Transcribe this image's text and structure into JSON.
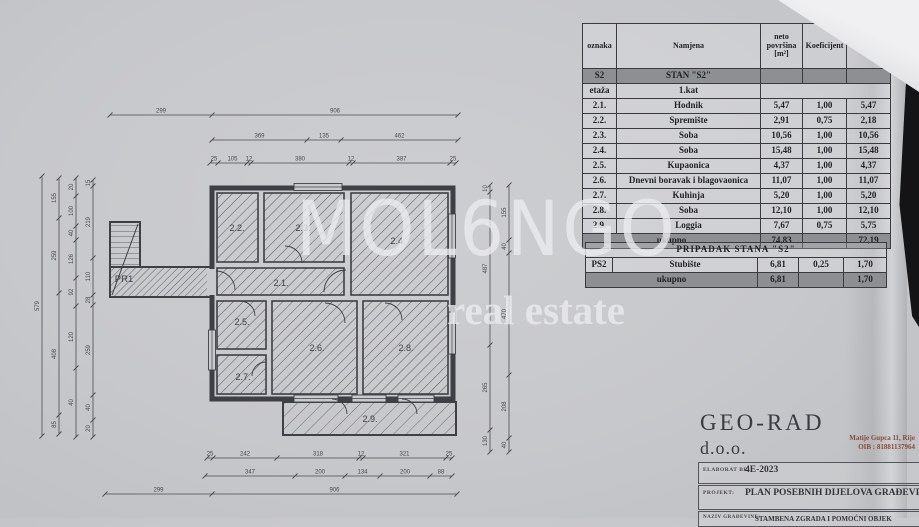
{
  "watermark": {
    "line1": "MOL6NGO",
    "line2": "real estate"
  },
  "main_table": {
    "headers": [
      "oznaka",
      "Namjena",
      "neto površina [m²]",
      "Koeficijent",
      "površina [m²]"
    ],
    "section_code": "S2",
    "section_title": "STAN \"S2\"",
    "floor_label": "etaža",
    "floor_value": "1.kat",
    "rows": [
      {
        "no": "2.1.",
        "name": "Hodnik",
        "neto": "5,47",
        "koef": "1,00",
        "povrsina": "5,47"
      },
      {
        "no": "2.2.",
        "name": "Spremište",
        "neto": "2,91",
        "koef": "0,75",
        "povrsina": "2,18"
      },
      {
        "no": "2.3.",
        "name": "Soba",
        "neto": "10,56",
        "koef": "1,00",
        "povrsina": "10,56"
      },
      {
        "no": "2.4.",
        "name": "Soba",
        "neto": "15,48",
        "koef": "1,00",
        "povrsina": "15,48"
      },
      {
        "no": "2.5.",
        "name": "Kupaonica",
        "neto": "4,37",
        "koef": "1,00",
        "povrsina": "4,37"
      },
      {
        "no": "2.6.",
        "name": "Dnevni boravak i blagovaonica",
        "neto": "11,07",
        "koef": "1,00",
        "povrsina": "11,07"
      },
      {
        "no": "2.7.",
        "name": "Kuhinja",
        "neto": "5,20",
        "koef": "1,00",
        "povrsina": "5,20"
      },
      {
        "no": "2.8.",
        "name": "Soba",
        "neto": "12,10",
        "koef": "1,00",
        "povrsina": "12,10"
      },
      {
        "no": "2.9.",
        "name": "Loggia",
        "neto": "7,67",
        "koef": "0,75",
        "povrsina": "5,75"
      }
    ],
    "total_label": "ukupno",
    "total_neto": "74,83",
    "total_povrsina": "72,19"
  },
  "annex_table": {
    "title": "PRIPADAK  STANA  \"S2\"",
    "rows": [
      {
        "no": "PS2",
        "name": "Stubište",
        "neto": "6,81",
        "koef": "0,25",
        "povrsina": "1,70"
      }
    ],
    "total_label": "ukupno",
    "total_neto": "6,81",
    "total_povrsina": "1,70"
  },
  "stamp": {
    "company": "GEO-RAD",
    "suffix": "d.o.o.",
    "address": "Matije Gupca 11, Rije",
    "oib": "OIB : 81881137964",
    "rows": [
      {
        "label": "ELABORAT BR:",
        "value": "4E-2023"
      },
      {
        "label": "PROJEKT:",
        "value": "PLAN POSEBNIH DIJELOVA GRAĐEVIN"
      },
      {
        "label": "NAZIV GRAĐEVINE:",
        "value": "STAMBENA ZGRADA I POMOĆNI OBJEK"
      }
    ]
  },
  "plan": {
    "rooms": [
      "2.1.",
      "2.2.",
      "2.3.",
      "2.4.",
      "2.5.",
      "2.6.",
      "2.7.",
      "2.8.",
      "2.9.",
      "PR1"
    ],
    "dimensions": {
      "top1": [
        "299",
        "906"
      ],
      "top2": [
        "369",
        "135",
        "462"
      ],
      "top3": [
        "25",
        "105",
        "12",
        "380",
        "12",
        "387",
        "25"
      ],
      "bottom1": [
        "25",
        "242",
        "318",
        "12",
        "321",
        "25"
      ],
      "bottom2": [
        "347",
        "200",
        "134",
        "200",
        "88"
      ],
      "bottom3": [
        "299",
        "906"
      ],
      "left1": [
        "579"
      ],
      "left2": [
        "155",
        "259",
        "408",
        "85"
      ],
      "left3": [
        "20",
        "100",
        "40",
        "126",
        "92",
        "120",
        "40"
      ],
      "left4": [
        "15",
        "219",
        "110",
        "28",
        "259",
        "40",
        "20"
      ],
      "right1": [
        "10",
        "487",
        "265",
        "130"
      ],
      "right2": [
        "155",
        "40",
        "470",
        "208",
        "40"
      ]
    }
  }
}
